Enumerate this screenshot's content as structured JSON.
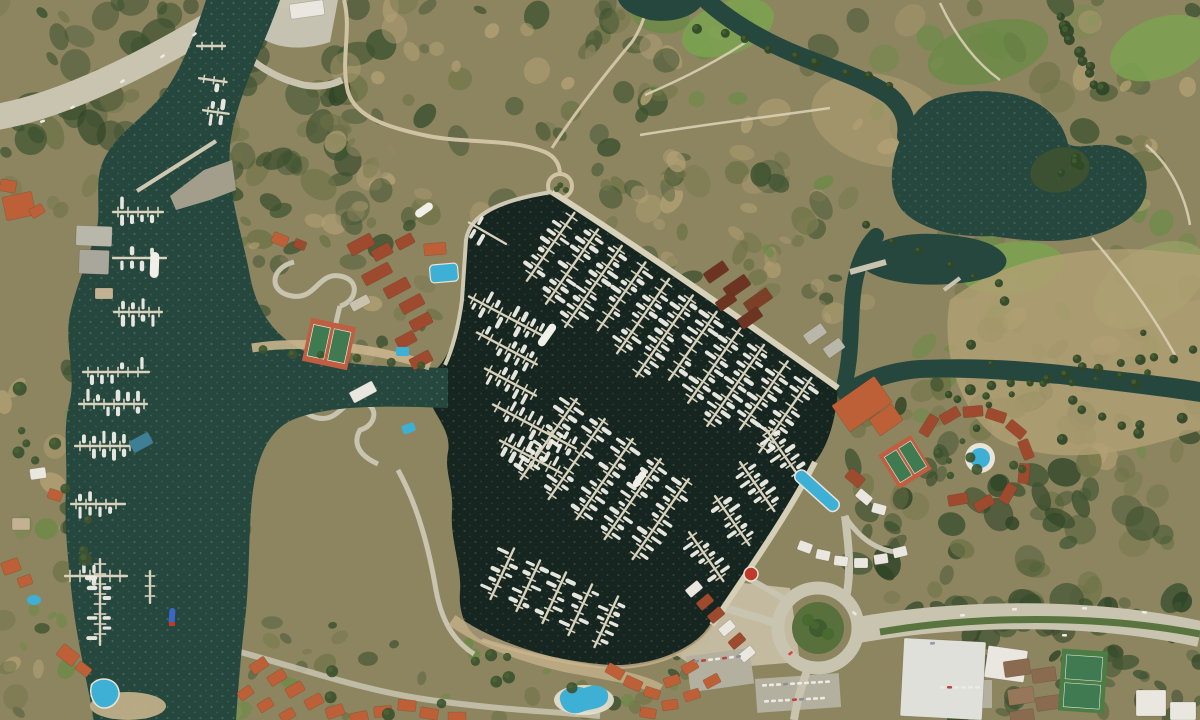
{
  "map": {
    "title": "Satellite aerial view — coastal marina and golf resort",
    "description": "Satellite imagery of a large marina basin filled with finger docks and white boats, a northern entrance channel with piers, a surrounding scrubland hillside, a golf course with ponds and winding cart paths to the northeast, a resort complex with a round pool, tennis courts and red-roofed villas to the east, a waterfront village with terracotta roofs, a traffic roundabout and a divided road to the southeast.",
    "visible_text": [],
    "imagery_type": "satellite-photo",
    "features": [
      {
        "id": "marina-basin",
        "label": "Main marina basin with finger docks and moored boats"
      },
      {
        "id": "north-channel",
        "label": "Northern entrance channel with T-piers and breakwater"
      },
      {
        "id": "west-arm",
        "label": "Western marina arm with docks along the shore"
      },
      {
        "id": "golf-course",
        "label": "Golf course fairways, dry roughs and cart paths"
      },
      {
        "id": "golf-ponds",
        "label": "Dark golf course ponds with island"
      },
      {
        "id": "river-channel",
        "label": "Winding water channel entering from the north"
      },
      {
        "id": "east-channel",
        "label": "Palm-lined channel running to the east edge"
      },
      {
        "id": "highway",
        "label": "Curving highway in the northwest corner"
      },
      {
        "id": "tennis-courts-west",
        "label": "Clay tennis courts near the west shore"
      },
      {
        "id": "resort-east",
        "label": "Resort with circular pool, villas and tennis courts"
      },
      {
        "id": "lap-pool",
        "label": "Long blue lap pool"
      },
      {
        "id": "roundabout",
        "label": "Traffic roundabout with green center"
      },
      {
        "id": "divided-road",
        "label": "Divided road with green median, southeast"
      },
      {
        "id": "village",
        "label": "Waterfront village with terracotta roofs and pool"
      },
      {
        "id": "ruins",
        "label": "Rust-brown ruined structure on the northeast shore"
      },
      {
        "id": "parking",
        "label": "Parking lots with rows of cars"
      },
      {
        "id": "white-building",
        "label": "Large white flat-roofed building, bottom right"
      },
      {
        "id": "blue-boat",
        "label": "Small blue-hulled boat in the west arm"
      },
      {
        "id": "red-kiosk",
        "label": "Round red-roofed kiosk on the waterfront promenade"
      }
    ],
    "palette": {
      "land_scrub": "#8d8560",
      "land_olive": "#6f7347",
      "forest": "#3d5230",
      "forest_dark": "#2f4527",
      "dry_tan": "#b2a074",
      "sand": "#c9b48d",
      "grass_bright": "#7ca251",
      "grass_mid": "#6c8a47",
      "water_dark": "#16251f",
      "water_mid": "#26473e",
      "water_light": "#2f5a4d",
      "speckle": "#8fc3ae",
      "road": "#c9c4b0",
      "road_minor": "#cfc3a4",
      "dock": "#d9d3bd",
      "boat": "#f0efe8",
      "roof_orange": "#bd6038",
      "roof_red": "#9e4a2e",
      "ruin": "#6e3423",
      "pool": "#3fb0d5",
      "court_clay": "#bf5e40",
      "court_green": "#3f7a50",
      "concrete": "#b9b7aa",
      "white_bldg": "#e9e7df",
      "blue_boat": "#3b66c8",
      "roof_blue": "#3f7f96",
      "median_green": "#59743f"
    }
  }
}
